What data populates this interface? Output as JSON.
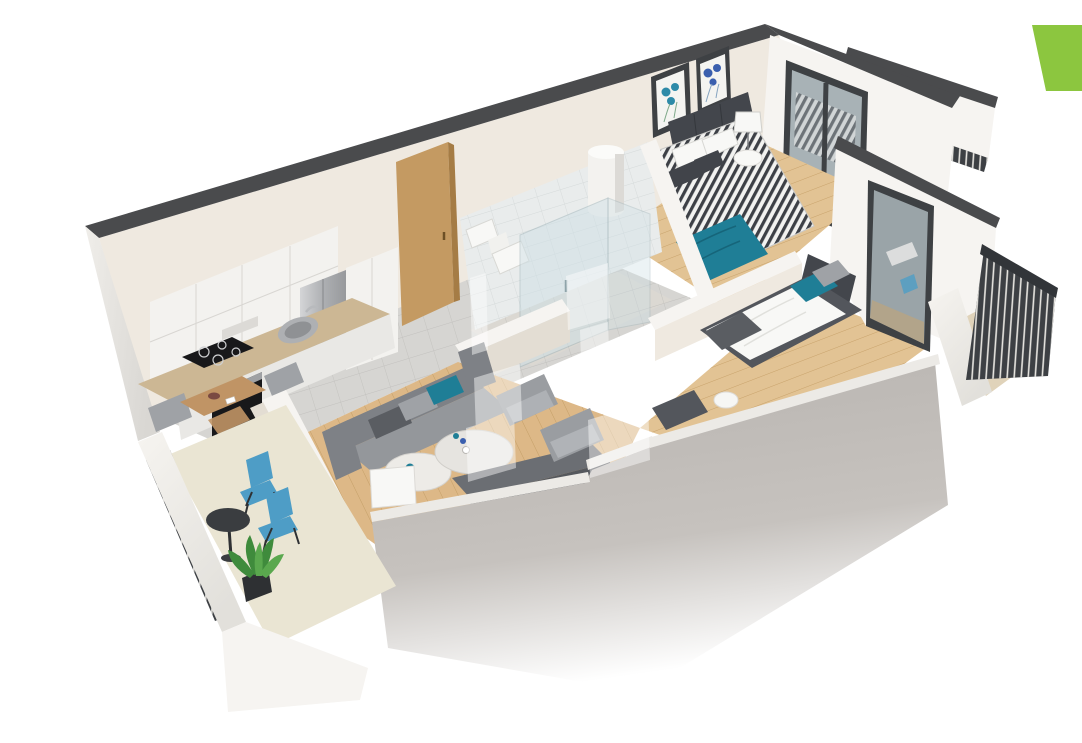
{
  "meta": {
    "kind": "3d-floor-plan-render",
    "view": "isometric-top-down",
    "rooms_visible": 9
  },
  "branding": {
    "corner_accent": "green-parallelogram-top-right",
    "watermark": "translucent-logo-center"
  },
  "colors": {
    "background": "#ffffff",
    "logoGreen": "#8cc63f",
    "watermark": "#ffffff",
    "wallTop": "#4a4b4d",
    "wallWhite": "#f6f4f1",
    "wallCream": "#efe9e0",
    "wallFace": "#e3ddd3",
    "facadeEdge": "#eceae6",
    "tile": "#d6d5d2",
    "bathTile": "#e9ecec",
    "bathFloor": "#dbd8d2",
    "woodBed": "#e2c394",
    "woodLiving": "#ddb887",
    "terraceFloor": "#eae5d3",
    "balconyWood": "#e0d3ba",
    "counter": "#ccb794",
    "cabinet": "#f3f2ef",
    "cabinetLow": "#e9e8e5",
    "applianceDark": "#18181a",
    "doorWood": "#c49a62",
    "tableWood": "#c09465",
    "showerGlass": "#cfe0e6",
    "windowGlass": "#a8b2b6",
    "frameDark": "#3e4144",
    "sofa": "#94979b",
    "sofaDark": "#7e8186",
    "cushionDark": "#5a5d62",
    "cushionGray": "#9fa2a6",
    "armchair": "#9a9da1",
    "teal": "#1f7e96",
    "chairBlue": "#4e9dc6",
    "duvetDark": "#41444a",
    "bedFrame": "#53565c",
    "headboard": "#43464c",
    "whiteSoft": "#f8f8f6",
    "railing": "#3d4044",
    "marble": "#edebe7",
    "sideboard": "#6b6e73",
    "sideboardFront": "#55585d",
    "plantGreen": "#3f8b3c",
    "plantLight": "#5aa84e",
    "potDark": "#2e3033",
    "artTeal": "#2d8aa8",
    "artBlue": "#3a5fae"
  },
  "scene": {
    "rooms": [
      {
        "name": "kitchen",
        "floor": "gray-tile",
        "furniture": [
          "upper-cabinets",
          "travertine-countertop",
          "induction-cooktop",
          "sink",
          "built-in-oven",
          "fridge",
          "tall-cabinet"
        ]
      },
      {
        "name": "dining-area",
        "floor": "gray-tile",
        "furniture": [
          "wooden-dining-table",
          "upholstered-chairs",
          "wooden-chair"
        ]
      },
      {
        "name": "living-room",
        "floor": "wood-planks",
        "furniture": [
          "gray-sofa",
          "teal-cushion",
          "marble-coffee-tables",
          "white-floor-lamp",
          "two-armchairs",
          "tv-sideboard"
        ]
      },
      {
        "name": "hallway",
        "floor": "gray-tile",
        "furniture": [
          "wooden-entrance-door",
          "thresholds"
        ]
      },
      {
        "name": "bathroom",
        "floor": "gray-tile",
        "furniture": [
          "glass-shower-enclosure",
          "wall-hung-toilet",
          "washbasin",
          "water-heater-cylinder"
        ]
      },
      {
        "name": "main-bedroom",
        "floor": "wood-planks",
        "furniture": [
          "double-bed-patterned-duvet",
          "teal-throw",
          "dark-headboard",
          "pillows",
          "round-nightstand",
          "table-lamp",
          "two-framed-artworks",
          "balcony-window"
        ]
      },
      {
        "name": "second-bedroom",
        "floor": "wood-planks",
        "furniture": [
          "single-bed-white-duvet",
          "teal-pillow",
          "gray-pillow",
          "dark-bench",
          "side-table",
          "glass-balcony-door"
        ]
      },
      {
        "name": "terrace",
        "floor": "cream-tile",
        "furniture": [
          "two-blue-bistro-chairs",
          "round-bistro-table",
          "potted-plant",
          "metal-railing",
          "white-parapet"
        ]
      },
      {
        "name": "side-balcony",
        "floor": "wood-decking",
        "furniture": [
          "dark-metal-railing"
        ]
      }
    ]
  }
}
